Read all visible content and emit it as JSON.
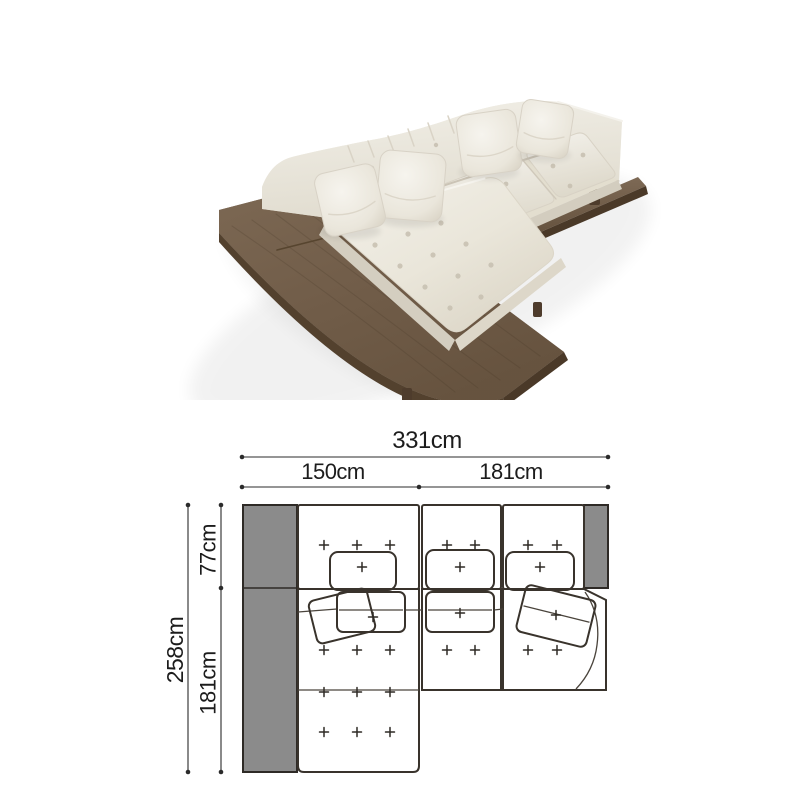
{
  "diagram": {
    "unit": "cm",
    "labels": {
      "total_width": "331cm",
      "section_left_width": "150cm",
      "section_right_width": "181cm",
      "total_depth": "258cm",
      "back_depth": "77cm",
      "chaise_depth": "181cm"
    },
    "values_cm": {
      "total_width": 331,
      "section_left_width": 150,
      "section_right_width": 181,
      "total_depth": 258,
      "back_depth": 77,
      "chaise_depth": 181
    }
  },
  "colors": {
    "background": "#ffffff",
    "wood": "#75604c",
    "wood_light": "#7e6a55",
    "wood_dark": "#53412e",
    "fabric": "#ece8dd",
    "fabric_shadow": "#d8d2c4",
    "plan_gray": "#8b8b8b",
    "outline": "#39332c",
    "dimension_line": "#2b2b2b",
    "text": "#1c1c1c"
  }
}
